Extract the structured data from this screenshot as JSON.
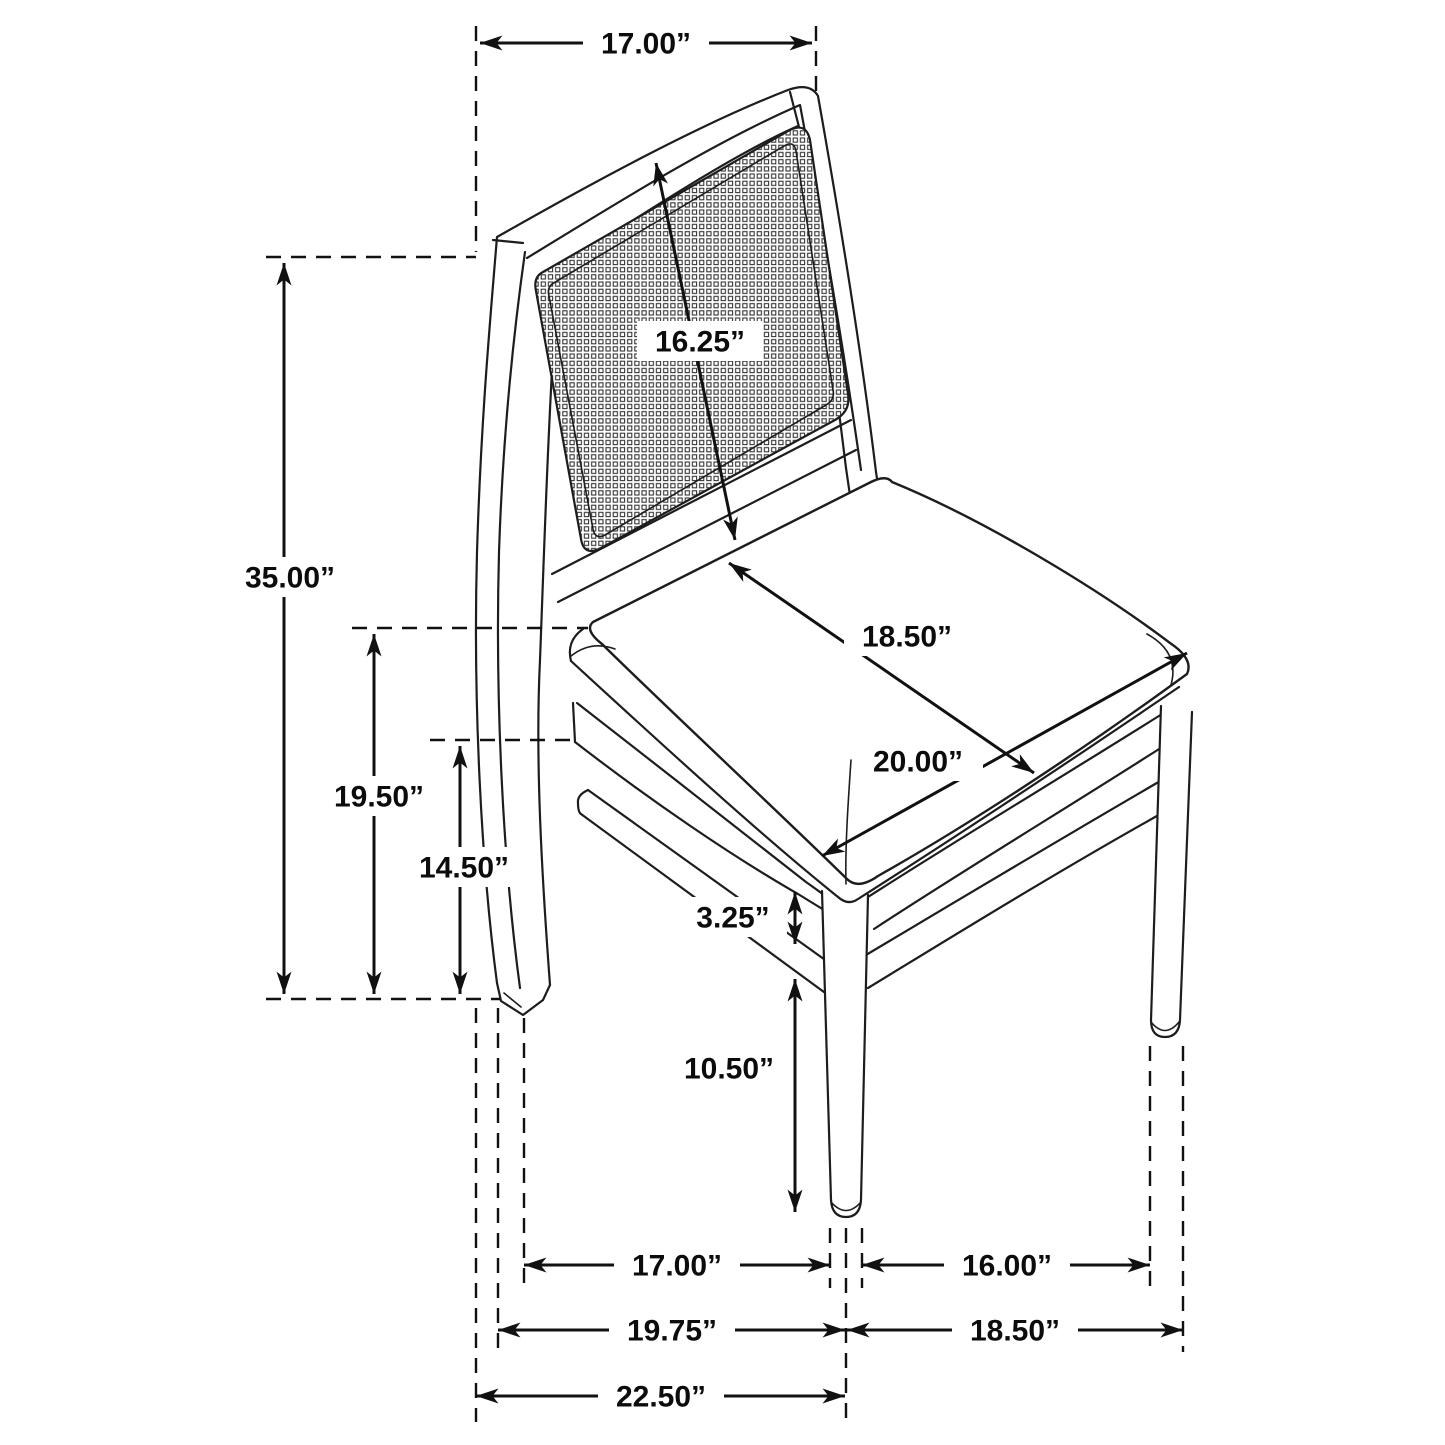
{
  "diagram": {
    "subject": "Side chair with cane back panel and upholstered seat - dimension drawing",
    "unit": "inches",
    "dims": {
      "back_top_width": "17.00”",
      "overall_height": "35.00”",
      "back_panel_height": "16.25”",
      "floor_to_seat_top": "19.50”",
      "floor_to_apron_bottom": "14.50”",
      "seat_depth": "18.50”",
      "seat_width": "20.00”",
      "apron_stretcher_gap": "3.25”",
      "stretcher_to_floor": "10.50”",
      "leg_span_side_inner": "17.00”",
      "leg_span_front_inner": "16.00”",
      "leg_span_side_center": "19.75”",
      "leg_span_front_outer": "18.50”",
      "overall_depth": "22.50”"
    }
  }
}
